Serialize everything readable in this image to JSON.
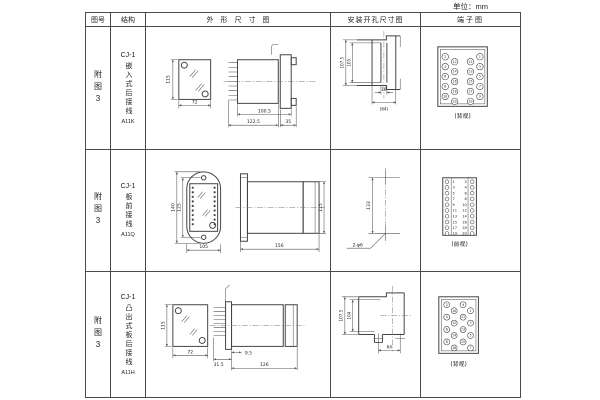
{
  "unit_note": "单位：mm",
  "table": {
    "headers": [
      "图号",
      "结构",
      "外形尺寸图",
      "安装开孔尺寸图",
      "端子图"
    ],
    "rows": [
      {
        "fig_no": "附图3",
        "structure": {
          "model": "CJ-1",
          "desc": "嵌入式后接线",
          "code": "A11K"
        },
        "outline": {
          "front_height": "115",
          "front_width": "72",
          "side_len1": "100.5",
          "side_len2": "122.5",
          "side_len3": "35"
        },
        "install": {
          "dim_outer": "107.5",
          "dim_inner": "105",
          "dim_w1": "16",
          "dim_w2": "(64)"
        },
        "terminal": {
          "view": "(背视)",
          "cols": {
            "outer_left": [
              "2",
              "4",
              "6",
              "8",
              "10"
            ],
            "inner_left": [
              "12",
              "14",
              "16",
              "18",
              "20"
            ],
            "inner_right": [
              "11",
              "13",
              "15",
              "17",
              "19"
            ],
            "outer_right": [
              "1",
              "3",
              "5",
              "7",
              "9"
            ]
          }
        }
      },
      {
        "fig_no": "附图3",
        "structure": {
          "model": "CJ-1",
          "desc": "板前接线",
          "code": "A11Q"
        },
        "outline": {
          "front_h_outer": "140",
          "front_h_inner": "125",
          "front_width": "105",
          "side_len": "156",
          "side_height": "115"
        },
        "install": {
          "dim_v": "133",
          "hole_label": "2-φ6"
        },
        "terminal": {
          "view": "(前视)",
          "left": [
            "1",
            "3",
            "5",
            "7",
            "9",
            "11",
            "13",
            "15",
            "17",
            "19"
          ],
          "right": [
            "2",
            "4",
            "6",
            "8",
            "10",
            "12",
            "14",
            "16",
            "18",
            "20"
          ]
        }
      },
      {
        "fig_no": "附图3",
        "structure": {
          "model": "CJ-1",
          "desc": "凸出式板后接线",
          "code": "A11H"
        },
        "outline": {
          "front_height": "115",
          "front_width": "72",
          "side_len_pins": "31.5",
          "side_len_step": "9.5",
          "side_len_total": "126"
        },
        "install": {
          "dim_outer": "107.5",
          "dim_inner": "104",
          "dim_w": "64"
        },
        "terminal": {
          "view": "(背视)",
          "cols": {
            "outer_left": [
              "2",
              "4",
              "6",
              "8"
            ],
            "inner_left": [
              "10",
              "12",
              "14",
              "16"
            ],
            "inner_right": [
              "9",
              "11",
              "13",
              "15"
            ],
            "outer_right": [
              "1",
              "3",
              "5",
              "7"
            ]
          }
        }
      }
    ]
  }
}
